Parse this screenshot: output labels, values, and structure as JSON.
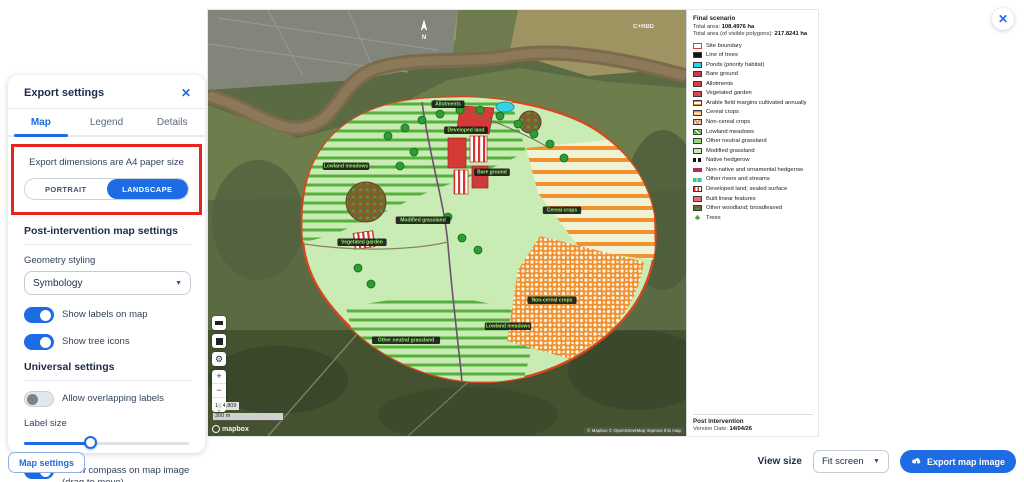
{
  "colors": {
    "accent": "#1e6ce3",
    "annotation_red": "#e8251d",
    "site_boundary": "#d2491f"
  },
  "page": {
    "close_icon": "✕"
  },
  "export_panel": {
    "title": "Export settings",
    "close_icon": "✕",
    "tabs": [
      {
        "label": "Map",
        "active": true
      },
      {
        "label": "Legend",
        "active": false
      },
      {
        "label": "Details",
        "active": false
      }
    ],
    "dimensions_note": "Export dimensions are A4 paper size",
    "orientation": {
      "portrait": "PORTRAIT",
      "landscape": "LANDSCAPE",
      "selected": "landscape"
    },
    "post_section_title": "Post-intervention map settings",
    "geometry_styling_label": "Geometry styling",
    "geometry_styling_value": "Symbology",
    "toggles": [
      {
        "label": "Show labels on map",
        "on": true
      },
      {
        "label": "Show tree icons",
        "on": true
      }
    ],
    "universal_section_title": "Universal settings",
    "overlap_toggle": {
      "label": "Allow overlapping labels",
      "on": false
    },
    "label_size_label": "Label size",
    "label_size_percent": 40,
    "compass_toggle": {
      "label": "Show compass on map image (drag to move)",
      "on": true
    }
  },
  "map_settings_button": "Map settings",
  "map": {
    "compass_letter": "N",
    "watermark": "C+RBD",
    "scale_ratio": "1 : 4,809",
    "scale_bar": "300 m",
    "logo_text": "mapbox",
    "attribution": "© Mapbox © OpenStreetMap Improve this map",
    "controls": {
      "zoom_in": "+",
      "zoom_out": "−",
      "gear": "⚙"
    },
    "labels": [
      {
        "x": 215,
        "y": 212,
        "text": "Modified grassland"
      },
      {
        "x": 354,
        "y": 202,
        "text": "Cereal crops"
      },
      {
        "x": 344,
        "y": 292,
        "text": "Non-cereal crops"
      },
      {
        "x": 138,
        "y": 158,
        "text": "Lowland meadows"
      },
      {
        "x": 258,
        "y": 122,
        "text": "Developed land"
      },
      {
        "x": 240,
        "y": 96,
        "text": "Allotments"
      },
      {
        "x": 154,
        "y": 234,
        "text": "Vegetated garden"
      },
      {
        "x": 198,
        "y": 332,
        "text": "Other neutral grassland"
      },
      {
        "x": 284,
        "y": 164,
        "text": "Bare ground"
      },
      {
        "x": 300,
        "y": 318,
        "text": "Lowland meadows"
      }
    ]
  },
  "legend": {
    "title": "Final scenario",
    "total_area_label": "Total area:",
    "total_area_value": "108.4976 ha",
    "visible_area_label": "Total area (of visible polygons):",
    "visible_area_value": "217.8241 ha",
    "items": [
      {
        "label": "Site boundary",
        "swatch": "site-boundary"
      },
      {
        "label": "Line of trees",
        "swatch": "black"
      },
      {
        "label": "Ponds (priority habitat)",
        "swatch": "cyan"
      },
      {
        "label": "Bare ground",
        "swatch": "crimson"
      },
      {
        "label": "Allotments",
        "swatch": "red"
      },
      {
        "label": "Vegetated garden",
        "swatch": "red2"
      },
      {
        "label": "Arable field margins cultivated annually",
        "swatch": "orange-lattice"
      },
      {
        "label": "Cereal crops",
        "swatch": "orange-stripes"
      },
      {
        "label": "Non-cereal crops",
        "swatch": "orange-grid"
      },
      {
        "label": "Lowland meadows",
        "swatch": "green-hatch"
      },
      {
        "label": "Other neutral grassland",
        "swatch": "green-mid"
      },
      {
        "label": "Modified grassland",
        "swatch": "green-pale"
      },
      {
        "label": "Native hedgerow",
        "swatch": "dash-black"
      },
      {
        "label": "Non-native and ornamental hedgerow",
        "swatch": "dash-red"
      },
      {
        "label": "Other rivers and streams",
        "swatch": "dash-water"
      },
      {
        "label": "Developed land; sealed surface",
        "swatch": "red-stripes"
      },
      {
        "label": "Built linear features",
        "swatch": "pink"
      },
      {
        "label": "Other woodland; broadleaved",
        "swatch": "woodland"
      },
      {
        "label": "Trees",
        "swatch": "tree-icon"
      }
    ],
    "footer_title": "Post Intervention",
    "version_label": "Version Date:",
    "version_value": "14/04/26"
  },
  "footer": {
    "view_size_label": "View size",
    "view_size_value": "Fit screen",
    "export_button_label": "Export map image"
  }
}
